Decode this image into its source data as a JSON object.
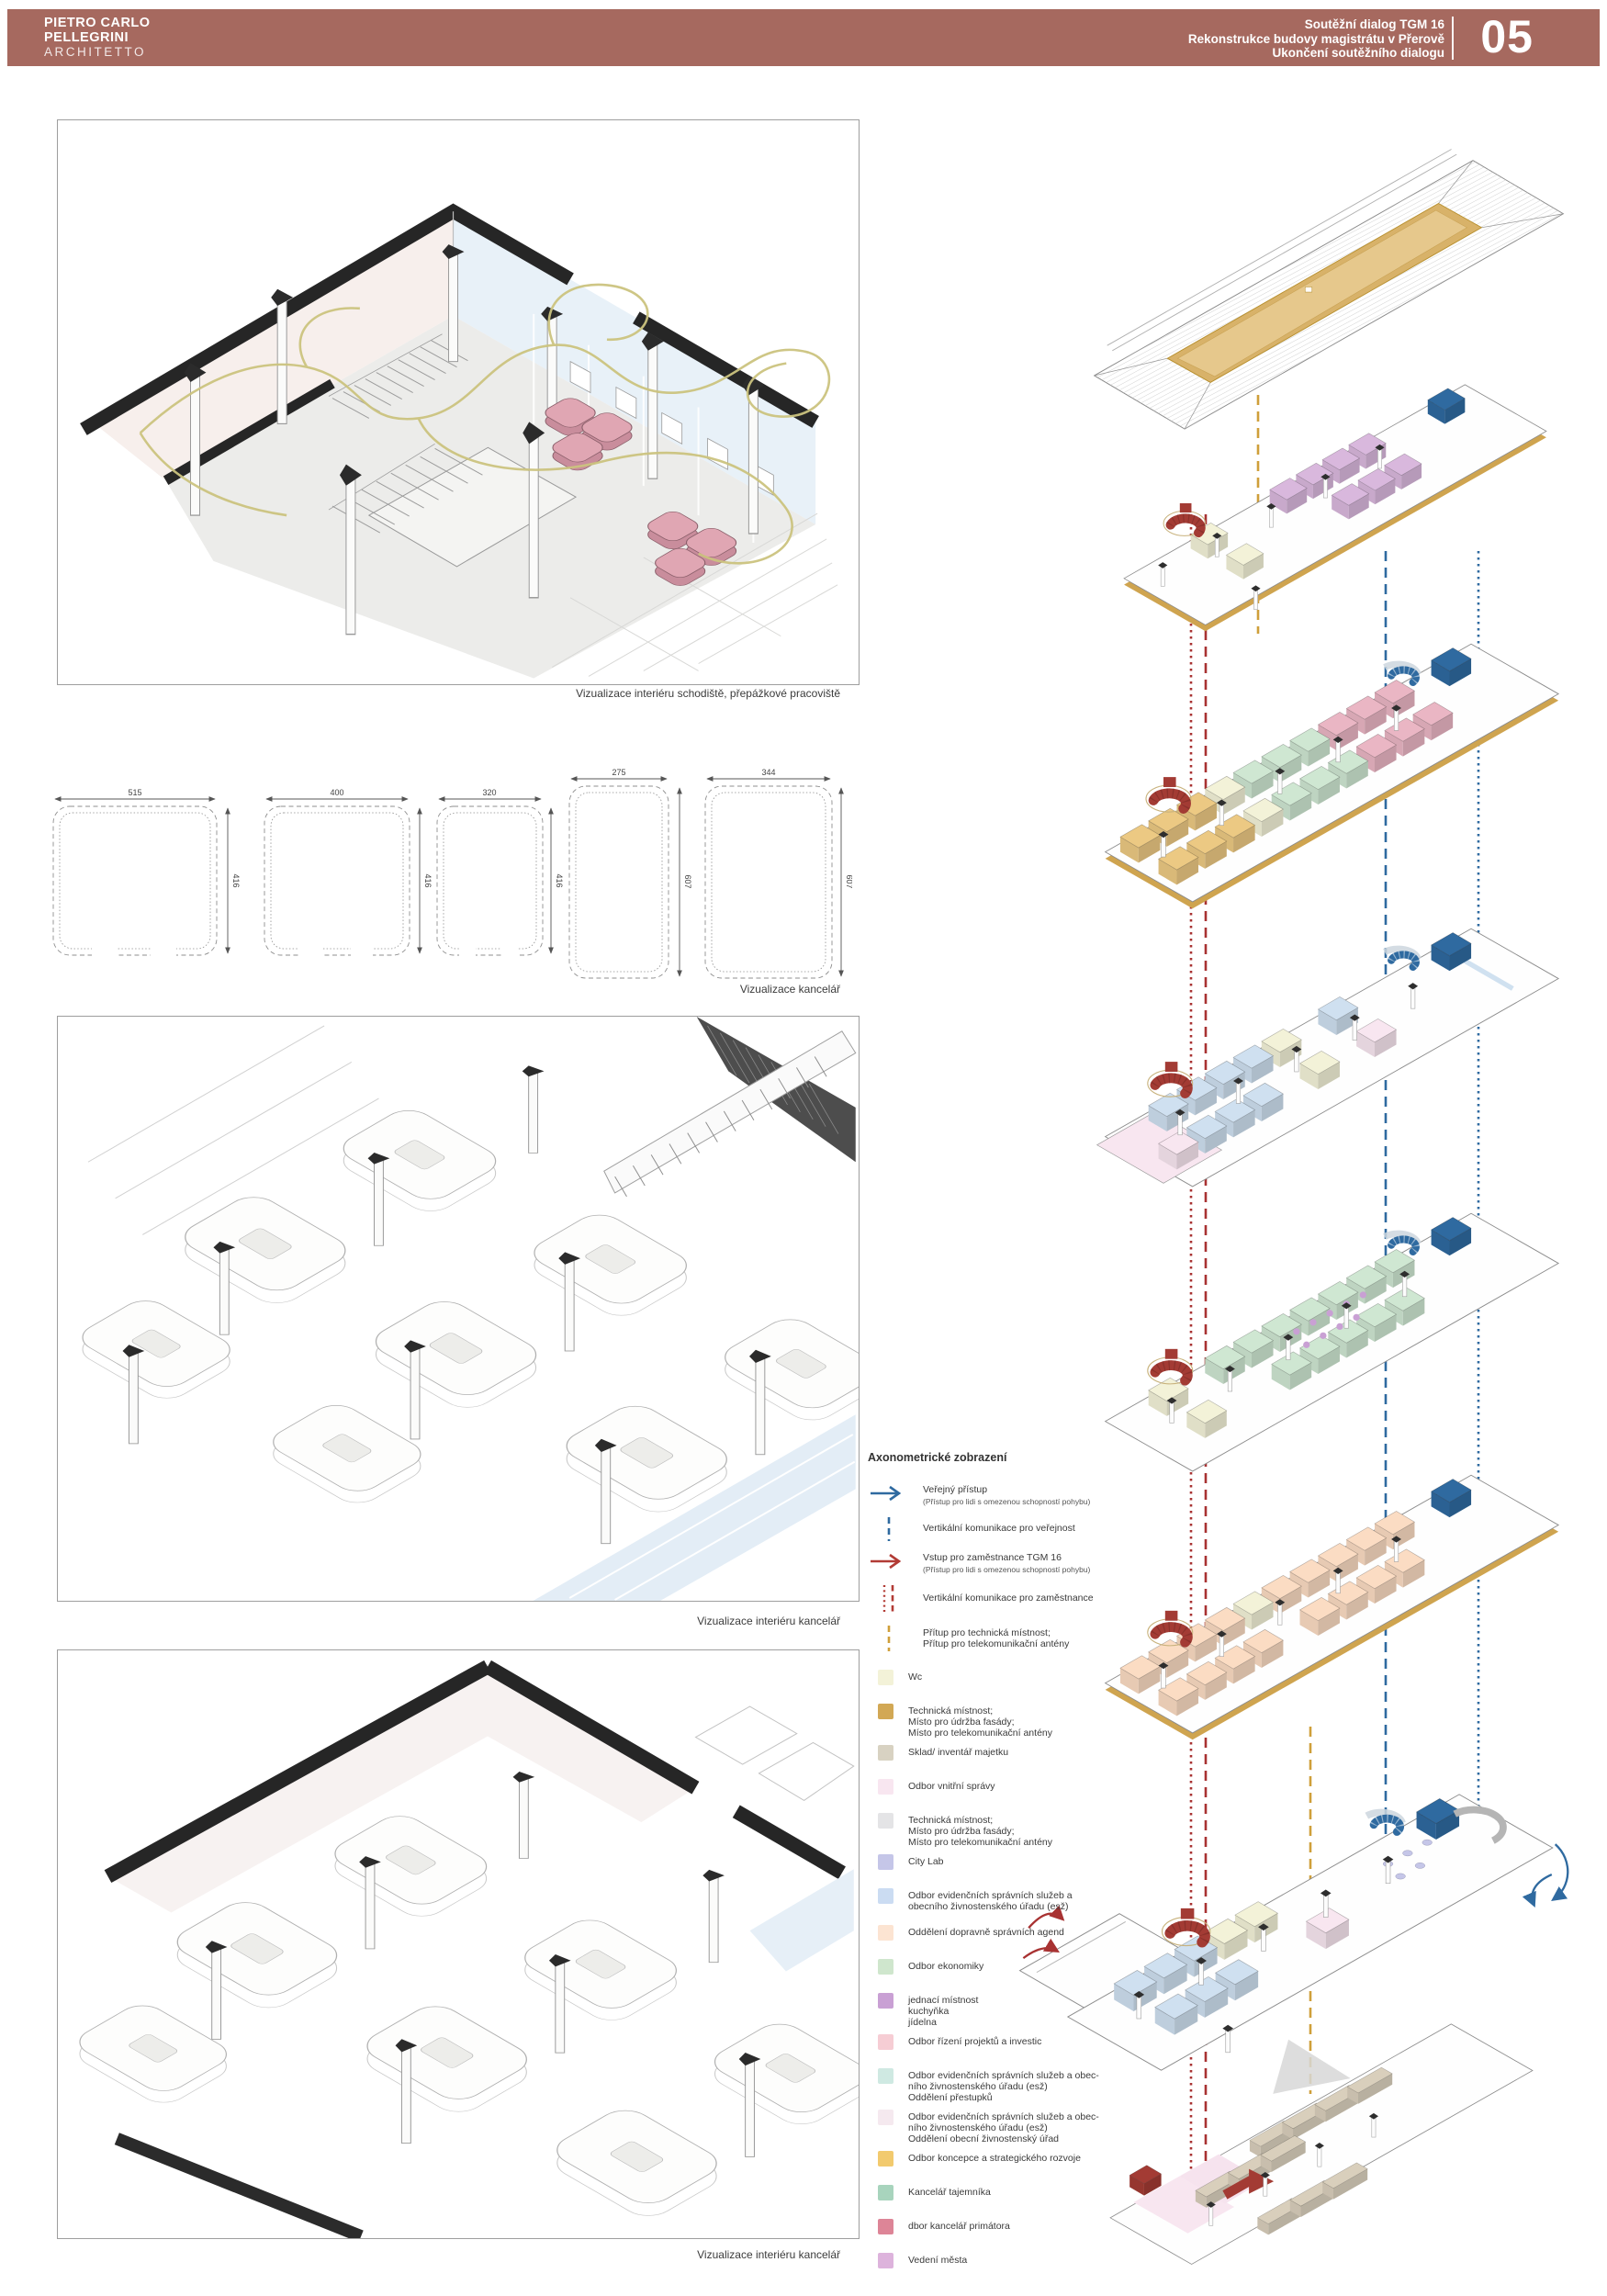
{
  "header": {
    "bar_color": "#a6695f",
    "studio": {
      "line1": "PIETRO CARLO",
      "line2": "PELLEGRINI",
      "line3": "ARCHITETTO"
    },
    "project": {
      "line1": "Soutěžní dialog TGM 16",
      "line2": "Rekonstrukce budovy magistrátu v Přerově",
      "line3": "Ukončení soutěžního dialogu"
    },
    "page_number": "05"
  },
  "captions": {
    "viz1": "Vizualizace interiéru schodiště, přepážkové pracoviště",
    "viz2": "Vizualizace kancelář",
    "viz3": "Vizualizace interiéru kancelář",
    "viz4": "Vizualizace interiéru kancelář"
  },
  "dimensions": {
    "desks": [
      {
        "w": "515",
        "h": "416"
      },
      {
        "w": "400",
        "h": "416"
      },
      {
        "w": "320",
        "h": "416"
      },
      {
        "w": "275",
        "h": "607"
      },
      {
        "w": "344",
        "h": "607"
      }
    ]
  },
  "legend": {
    "title": "Axonometrické zobrazení",
    "flows": [
      {
        "type": "arrow",
        "color": "#2f6aa0",
        "label": "Veřejný přístup",
        "sub": "(Přístup pro lidi s omezenou schopností pohybu)"
      },
      {
        "type": "dashed",
        "color": "#2f6aa0",
        "label": "Vertikální komunikace pro veřejnost"
      },
      {
        "type": "arrow",
        "color": "#b23b35",
        "label": "Vstup pro zaměstnance TGM 16",
        "sub": "(Přístup pro lidi s omezenou schopností pohybu)"
      },
      {
        "type": "dotted-dashed",
        "color": "#b23b35",
        "label": "Vertikální komunikace pro zaměstnance"
      },
      {
        "type": "dashed",
        "color": "#cf9f3a",
        "label": "Přítup pro technická místnost;\nPřítup pro telekomunikační antény"
      }
    ],
    "items": [
      {
        "color": "#f3f2d8",
        "label": "Wc"
      },
      {
        "color": "#d2a855",
        "label": "Technická místnost;\nMísto pro údržba fasády;\nMísto pro telekomunikační antény"
      },
      {
        "color": "#d8d2c2",
        "label": "Sklad/ inventář majetku"
      },
      {
        "color": "#f8e6f0",
        "label": "Odbor vnitřní správy"
      },
      {
        "color": "#e4e4e6",
        "label": "Technická místnost;\nMísto pro údržba fasády;\nMísto pro telekomunikační antény"
      },
      {
        "color": "#c5c6e8",
        "label": "City Lab"
      },
      {
        "color": "#cbdcf2",
        "label": "Odbor evidenčních správních služeb a\nobecního živnostenského úřadu (esž)"
      },
      {
        "color": "#fce4d2",
        "label": "Oddělení dopravně správních agend"
      },
      {
        "color": "#cfe6cd",
        "label": "Odbor ekonomiky"
      },
      {
        "color": "#c9a0d4",
        "label": "jednací místnost\nkuchyňka\njídelna"
      },
      {
        "color": "#f6cdd4",
        "label": "Odbor řízení projektů a investic"
      },
      {
        "color": "#cfe9e2",
        "label": "Odbor evidenčních správních služeb a obec-\nního živnostenského úřadu (esž)\nOddělení přestupků"
      },
      {
        "color": "#f5e9ef",
        "label": "Odbor evidenčních správních služeb a obec-\nního živnostenského úřadu (esž)\nOddělení obecní živnostenský úřad"
      },
      {
        "color": "#f2ca6e",
        "label": "Odbor koncepce a strategického rozvoje"
      },
      {
        "color": "#a8d4bd",
        "label": "Kancelář tajemníka"
      },
      {
        "color": "#dd8597",
        "label": "dbor kancelář primátora"
      },
      {
        "color": "#ddb3dc",
        "label": "Vedení města"
      }
    ]
  },
  "axon": {
    "flow_blue": "#2f6aa0",
    "flow_red": "#a83232",
    "flow_gold": "#cf9f3a",
    "plate_gold": "#cfa44f",
    "room_colors": {
      "wc": "#f3f2d8",
      "lilac": "#d9b8dd",
      "gold": "#ecc983",
      "green": "#cfe7d2",
      "pink": "#eab6c4",
      "blue": "#cfe0f0",
      "peach": "#fbdcc3",
      "purple": "#c9a0d4",
      "core_blue": "#2f6aa0",
      "stair_red": "#a33b34",
      "shelf": "#d9cfbc",
      "pale_pink": "#f8e6f0"
    }
  }
}
